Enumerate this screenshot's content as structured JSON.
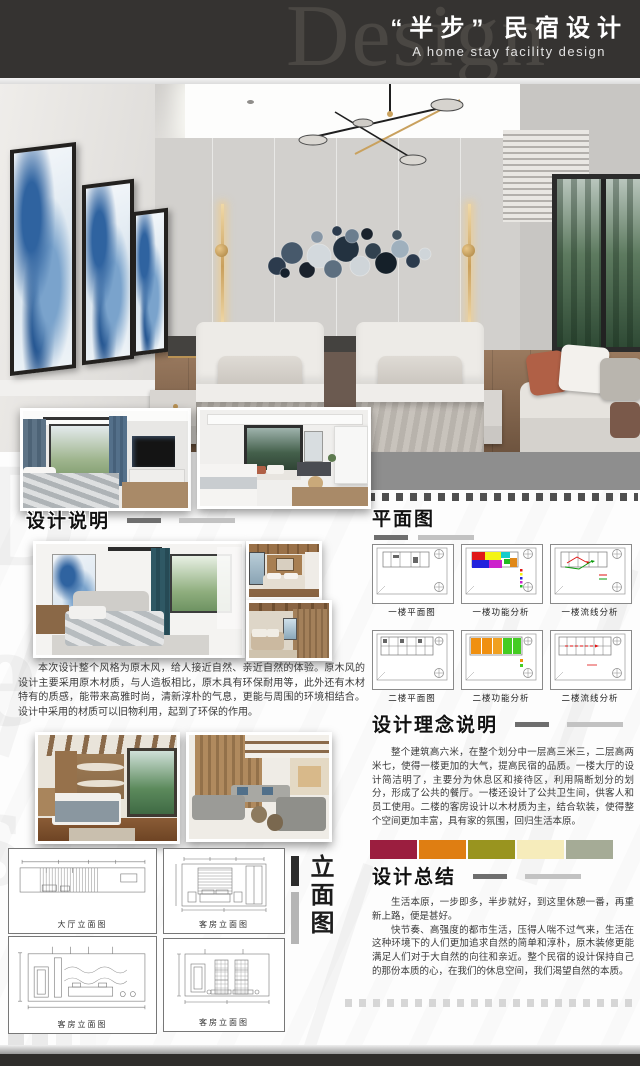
{
  "header": {
    "watermark": "Design",
    "title": "“半步” 民宿设计",
    "subtitle": "A home stay facility design"
  },
  "design_desc": {
    "heading": "设计说明",
    "body": "本次设计整个风格为原木风，给人接近自然、亲近自然的体验。原木风的设计主要采用原木材质，与人造板相比，原木具有环保耐用等，此外还有木材特有的质感，能带来高雅时尚，清新淳朴的气息，更能与周围的环境相结合。设计中采用的材质可以旧物利用，起到了环保的作用。"
  },
  "floor_plans": {
    "heading": "平面图",
    "items": [
      {
        "caption": "一楼平面图"
      },
      {
        "caption": "一楼功能分析"
      },
      {
        "caption": "一楼流线分析"
      },
      {
        "caption": "二楼平面图"
      },
      {
        "caption": "二楼功能分析"
      },
      {
        "caption": "二楼流线分析"
      }
    ]
  },
  "concept": {
    "heading": "设计理念说明",
    "body": "整个建筑高六米，在整个划分中一层高三米三，二层高两米七，使得一楼更加的大气，提高民宿的品质。一楼大厅的设计简洁明了，主要分为休息区和接待区，利用隔断划分的划分，形成了公共的餐厅。一楼还设计了公共卫生间，供客人和员工使用。二楼的客房设计以木材质为主，结合软装，使得整个空间更加丰富，具有家的氛围，回归生活本原。"
  },
  "palette": [
    "#9B1E3F",
    "#DF7E12",
    "#99941F",
    "#F6ECBB",
    "#A5AB96"
  ],
  "summary": {
    "heading": "设计总结",
    "para1": "生活本原，一步即多，半步就好，到这里休憩一番，再重新上路，便是甚好。",
    "para2": "快节奏、高强度的都市生活，压得人喘不过气来，生活在这种环境下的人们更加追求自然的简单和淳朴，原木装修更能满足人们对于大自然的向往和亲近。整个民宿的设计保持自己的那份本质的心，在我们的休息空间，我们渴望自然的本质。"
  },
  "elevations": {
    "label": "立面图",
    "items": [
      {
        "caption": "大厅立面图"
      },
      {
        "caption": "客房立面图"
      },
      {
        "caption": "客房立面图"
      },
      {
        "caption": "客房立面图"
      }
    ]
  }
}
